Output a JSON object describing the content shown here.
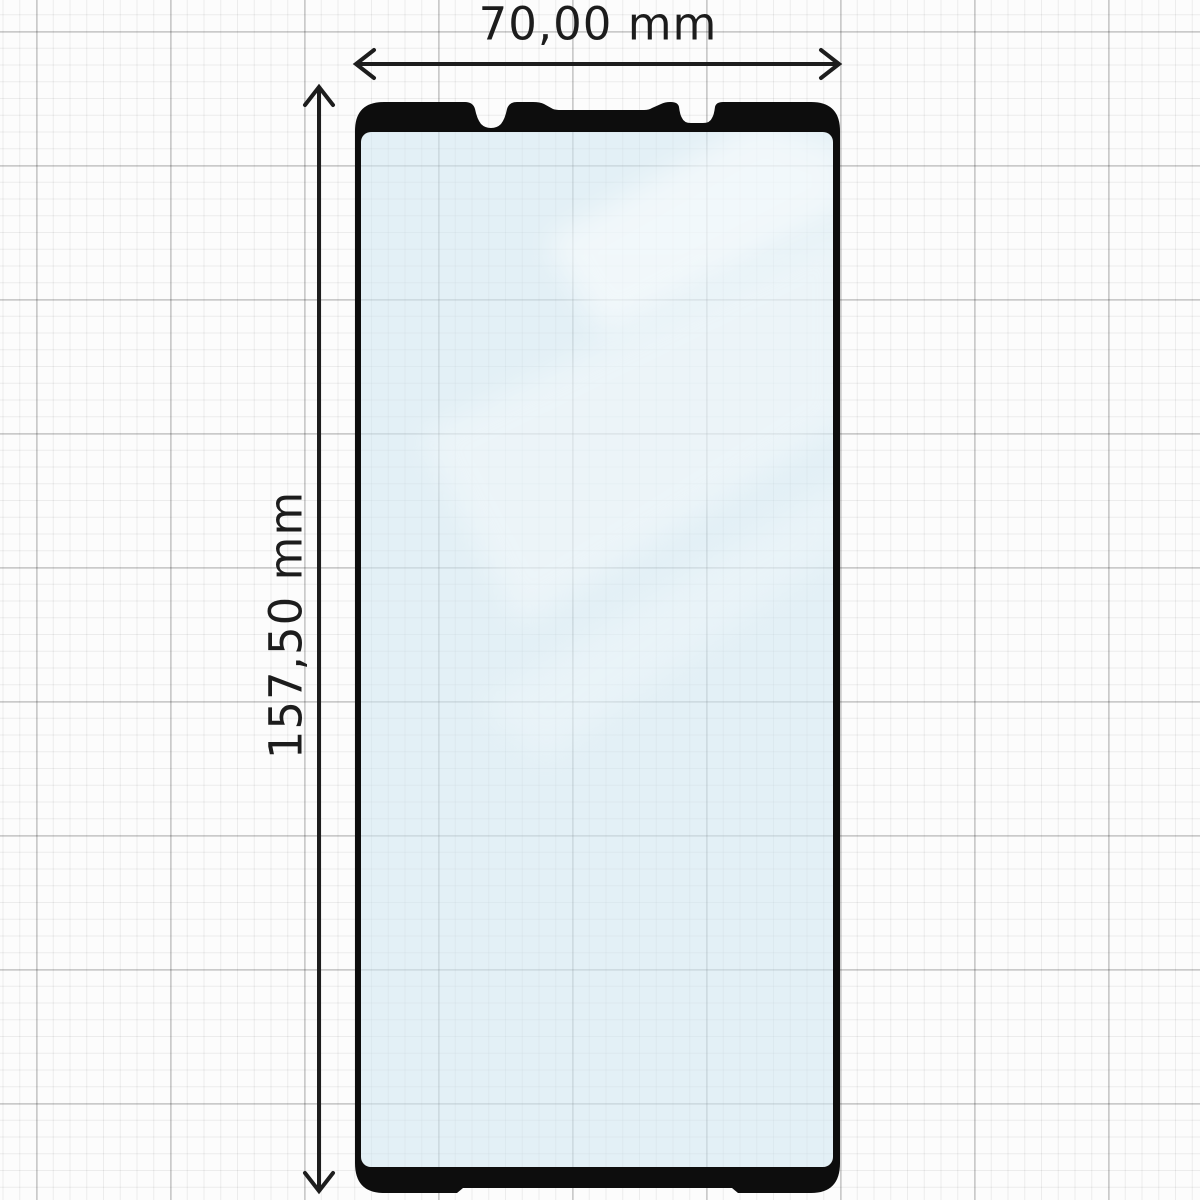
{
  "diagram": {
    "subject": "tempered-glass-screen-protector",
    "dimensions": {
      "width": {
        "label": "70,00 mm",
        "orientation": "horizontal"
      },
      "height": {
        "label": "157,50 mm",
        "orientation": "vertical"
      }
    },
    "colors": {
      "background": "#fcfcfc",
      "grid_minor": "#ebebeb",
      "grid_major": "#d8d8d8",
      "protector_outline": "#0d0d0d",
      "glass_tint": "#e4f0f6",
      "dimension_line": "#1d1d1d",
      "dimension_text": "#1c1c1c"
    }
  }
}
